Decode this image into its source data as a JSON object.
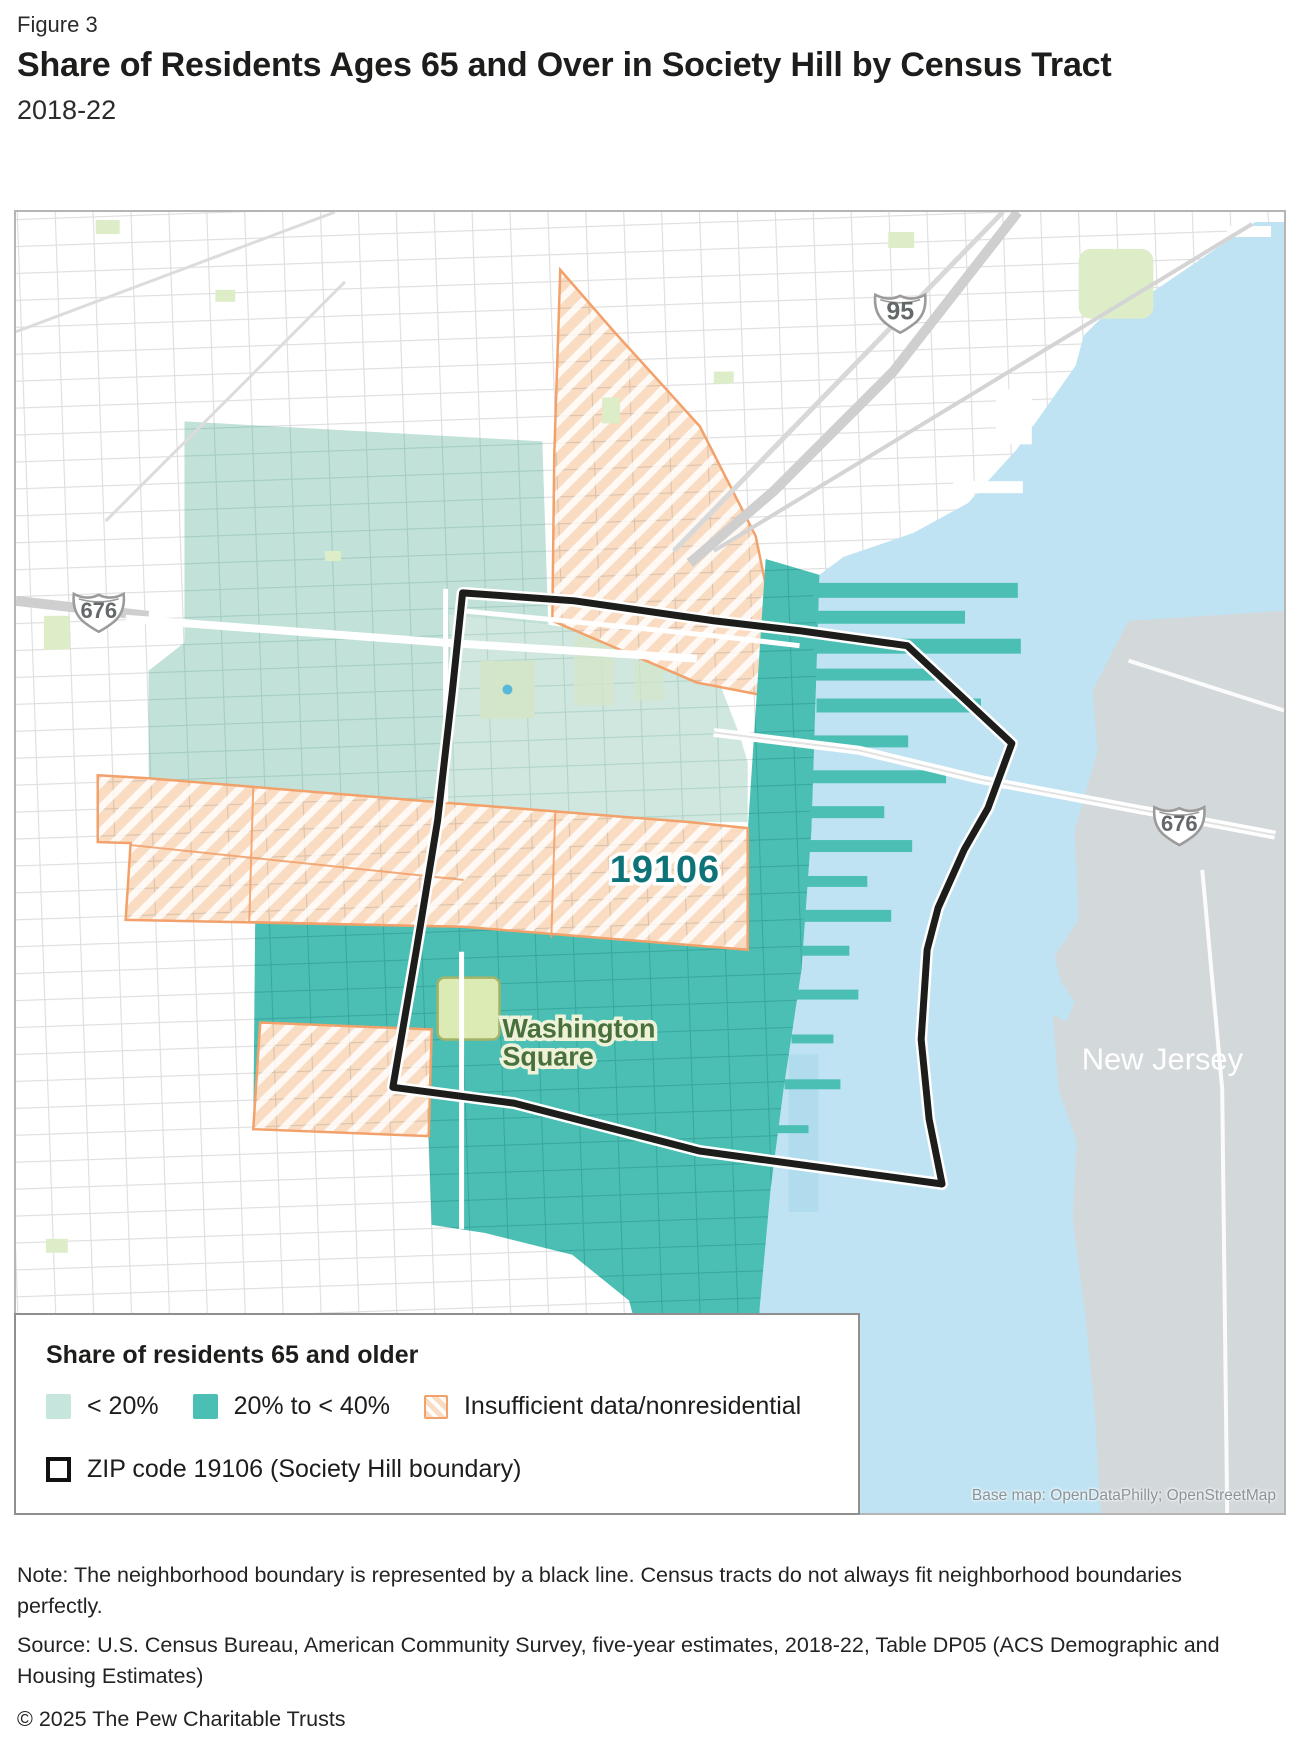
{
  "figure": {
    "eyebrow": "Figure 3",
    "title": "Share of Residents Ages 65 and Over in Society Hill by Census Tract",
    "subtitle": "2018-22"
  },
  "map": {
    "zip_label": "19106",
    "park_label_line1": "Washington",
    "park_label_line2": "Square",
    "state_label": "New Jersey",
    "attribution": "Base map: OpenDataPhilly; OpenStreetMap",
    "shields": {
      "i95": "95",
      "i676_west": "676",
      "i676_nj": "676"
    },
    "colors": {
      "share_lt20": "#c5e5dd",
      "share_20_to_40": "#4cbfb4",
      "insufficient_fill": "#fadcc2",
      "insufficient_border": "#f2a16b",
      "river": "#bfe3f2",
      "new_jersey_land": "#d3d8db",
      "zip_boundary": "#1d1d1b",
      "park": "#dcebb4"
    }
  },
  "legend": {
    "heading": "Share of residents 65 and older",
    "items": [
      {
        "id": "lt20",
        "label": "< 20%"
      },
      {
        "id": "b20to40",
        "label": "20% to < 40%"
      },
      {
        "id": "insufficient",
        "label": "Insufficient data/nonresidential"
      }
    ],
    "zip_item_label": "ZIP code 19106 (Society Hill boundary)"
  },
  "footer": {
    "note_lines": [
      "Note: The neighborhood boundary is represented by a black line. Census tracts do not always fit neighborhood boundaries",
      "perfectly."
    ],
    "source_lines": [
      "Source: U.S. Census Bureau, American Community Survey, five-year estimates, 2018-22, Table DP05 (ACS Demographic and",
      "Housing Estimates)"
    ],
    "copyright": "© 2025 The Pew Charitable Trusts"
  }
}
